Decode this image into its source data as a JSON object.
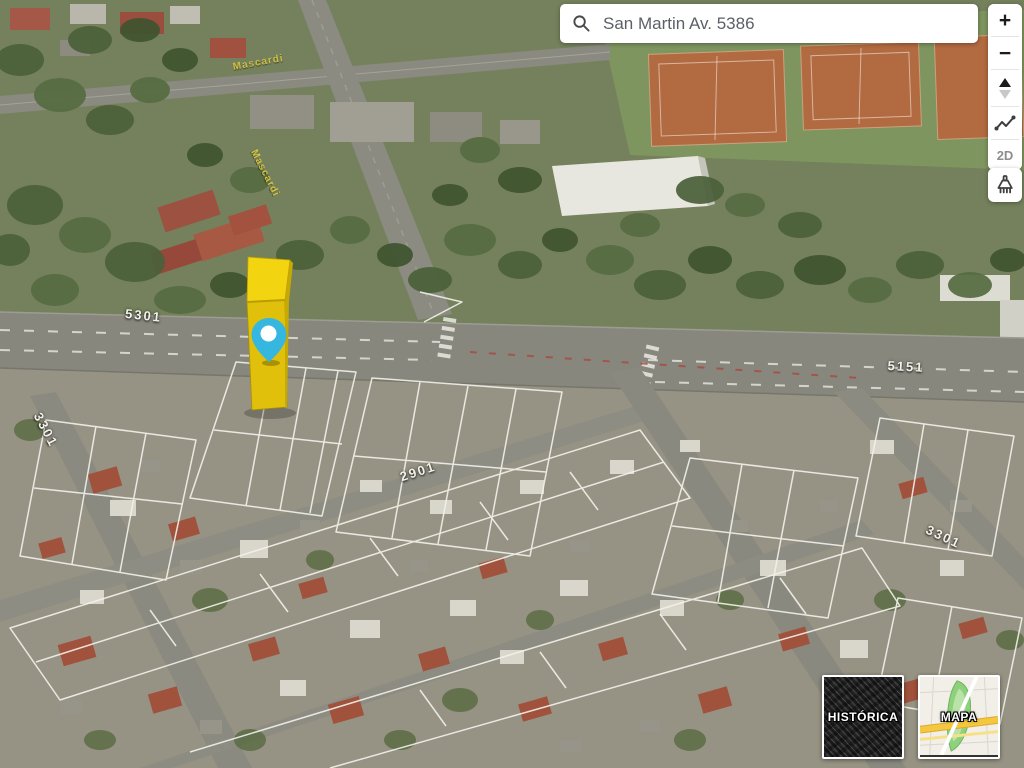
{
  "search": {
    "value": "San Martin Av. 5386"
  },
  "controls": {
    "zoom_in": "+",
    "zoom_out": "−",
    "view_2d": "2D",
    "icons": {
      "search": "magnifier-icon",
      "tilt": "up-down-triangles-icon",
      "elevation_profile": "polyline-icon",
      "clear": "broom-icon"
    }
  },
  "basemap_buttons": {
    "historic": "HISTÓRICA",
    "map": "MAPA"
  },
  "street_labels": [
    {
      "text": "5301"
    },
    {
      "text": "3301"
    },
    {
      "text": "2901"
    },
    {
      "text": "5151"
    },
    {
      "text": "3301"
    },
    {
      "text": "Mascardi"
    },
    {
      "text": "Mascardi"
    }
  ],
  "marker": {
    "building_color": "#e0c00a",
    "building_top_color": "#f2d411",
    "pin_color": "#35b7e0",
    "pin_dot_color": "#ffffff"
  },
  "theme": {
    "street_number_label_color": "#f2f1ea",
    "street_name_label_color": "#dcc944",
    "parcel_outline_color": "#f2f2ec"
  }
}
